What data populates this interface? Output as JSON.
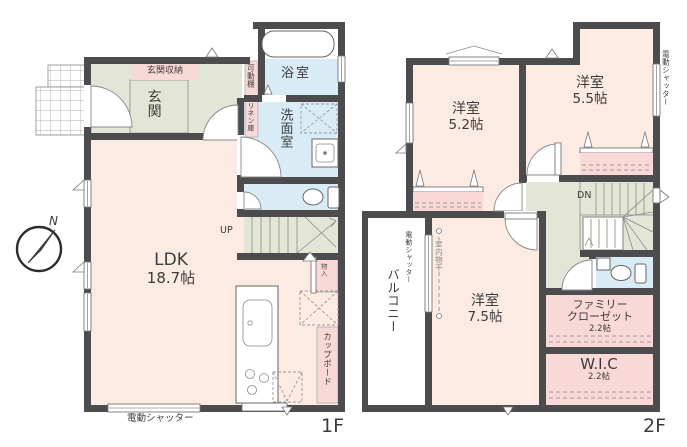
{
  "colors": {
    "wall": "#4c4c4f",
    "room": "#fcebe2",
    "hall": "#e3e5d6",
    "wet": "#d9ecf5",
    "pink": "#f9d9d8"
  },
  "floor1": {
    "label": "1F",
    "compass_north": "N",
    "entrance_storage": "玄関収納",
    "entrance": "玄関",
    "movable_shelf": "可動棚",
    "linen_closet": "リネン庫",
    "bathroom": "浴室",
    "washroom": "洗面室",
    "stairs_up": "UP",
    "storage": "物入",
    "ldk_name": "LDK",
    "ldk_size": "18.7帖",
    "cupboard": "カップボード",
    "shutter": "電動シャッター"
  },
  "floor2": {
    "label": "2F",
    "room_a_name": "洋室",
    "room_a_size": "5.2帖",
    "room_b_name": "洋室",
    "room_b_size": "5.5帖",
    "room_c_name": "洋室",
    "room_c_size": "7.5帖",
    "stairs_down": "DN",
    "family_closet_line1": "ファミリー",
    "family_closet_line2": "クローゼット",
    "family_closet_size": "2.2帖",
    "wic_name": "W.I.C",
    "wic_size": "2.2帖",
    "balcony": "バルコニー",
    "balcony_shutter": "電動シャッター",
    "right_shutter": "電動シャッター",
    "indoor_drying": "室内物干"
  }
}
